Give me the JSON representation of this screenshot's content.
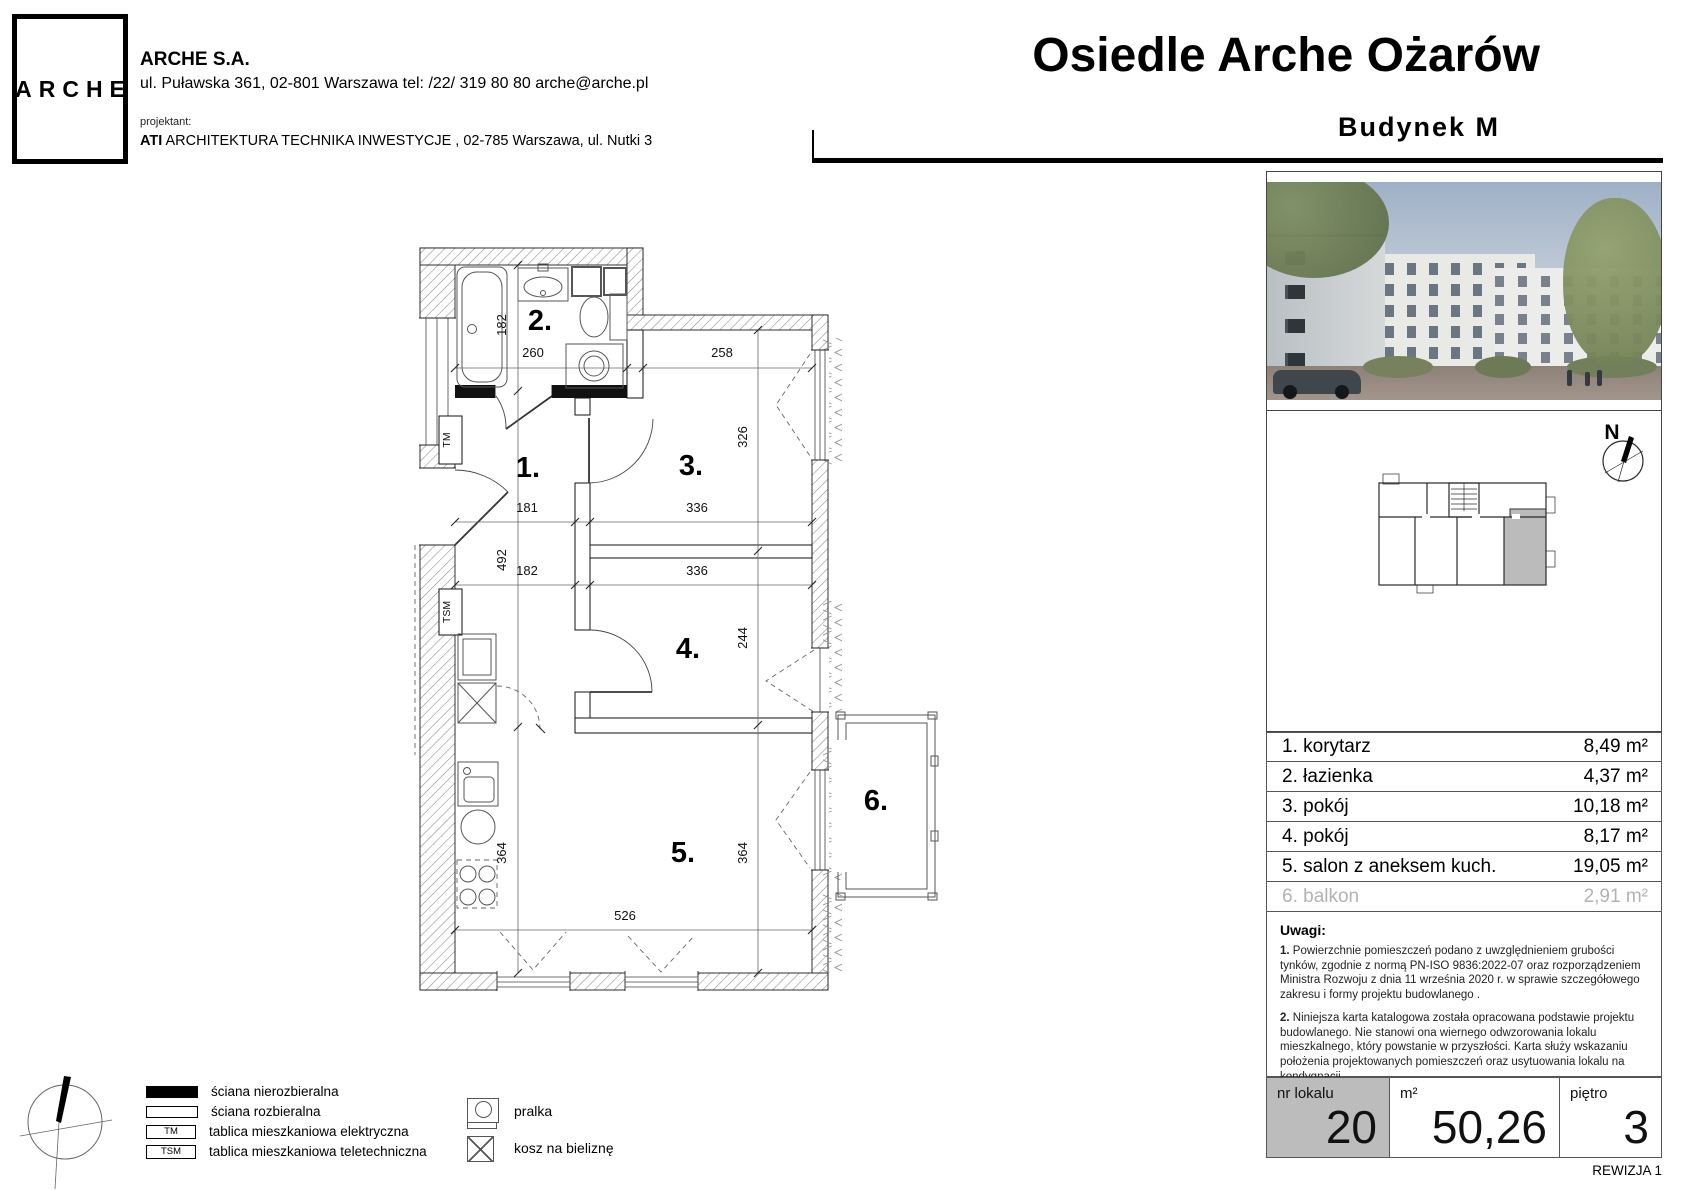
{
  "header": {
    "logo": "ARCHE",
    "company": "ARCHE S.A.",
    "address": "ul. Puławska 361, 02-801 Warszawa tel: /22/ 319 80 80 arche@arche.pl",
    "designer_label": "projektant:",
    "designer_name": "ATI",
    "designer_rest": " ARCHITEKTURA TECHNIKA INWESTYCJE , 02-785 Warszawa, ul. Nutki 3",
    "title": "Osiedle Arche Ożarów",
    "subtitle": "Budynek  M"
  },
  "plan": {
    "rooms": {
      "r1": "1.",
      "r2": "2.",
      "r3": "3.",
      "r4": "4.",
      "r5": "5.",
      "r6": "6."
    },
    "tm": "TM",
    "tsm": "TSM",
    "north": "N",
    "dims": {
      "bath_height": "182",
      "bath_width": "260",
      "room3_top": "258",
      "room3_height": "326",
      "hall_width_a": "181",
      "room3_width": "336",
      "hall_height": "492",
      "hall_width_b": "182",
      "room4_width": "336",
      "room4_height": "244",
      "salon_height_left": "364",
      "salon_height_right": "364",
      "salon_width": "526"
    }
  },
  "rooms_table": [
    {
      "label": "1. korytarz",
      "area": "8,49 m²"
    },
    {
      "label": "2. łazienka",
      "area": "4,37 m²"
    },
    {
      "label": "3. pokój",
      "area": "10,18 m²"
    },
    {
      "label": "4. pokój",
      "area": "8,17 m²"
    },
    {
      "label": "5. salon z aneksem kuch.",
      "area": "19,05 m²"
    },
    {
      "label": "6. balkon",
      "area": "2,91 m²"
    }
  ],
  "notes": {
    "title": "Uwagi:",
    "items": [
      {
        "num": "1.",
        "text": " Powierzchnie pomieszczeń podano z uwzględnieniem grubości tynków, zgodnie z normą PN-ISO 9836:2022-07 oraz rozporządzeniem Ministra Rozwoju z dnia 11 września 2020 r. w sprawie szczegółowego zakresu i formy projektu budowlanego ."
      },
      {
        "num": "2.",
        "text": " Niniejsza karta katalogowa została opracowana podstawie projektu budowlanego. Nie stanowi ona wiernego odwzorowania lokalu mieszkalnego, który powstanie w przyszłości. Karta służy wskazaniu położenia projektowanych pomieszczeń oraz usytuowania lokalu na kondygnacji."
      },
      {
        "num": "3.",
        "text": " Powierzchnie oraz wymiary mogą ulec niewielkim zmianom w trakcie realizacji obiektu."
      }
    ]
  },
  "summary": {
    "unit_label": "nr lokalu",
    "unit_value": "20",
    "area_label": "m²",
    "area_value": "50,26",
    "floor_label": "piętro",
    "floor_value": "3"
  },
  "revision": "REWIZJA 1",
  "legend": {
    "items": [
      {
        "mark": "",
        "label": "ściana nierozbieralna"
      },
      {
        "mark": "",
        "label": "ściana rozbieralna"
      },
      {
        "mark": "TM",
        "label": "tablica mieszkaniowa elektryczna"
      },
      {
        "mark": "TSM",
        "label": "tablica mieszkaniowa teletechniczna"
      }
    ],
    "washer": "pralka",
    "basket": "kosz na bieliznę"
  },
  "colors": {
    "highlight_gray": "#bcbcbc",
    "muted_text": "#b3b3b3"
  }
}
